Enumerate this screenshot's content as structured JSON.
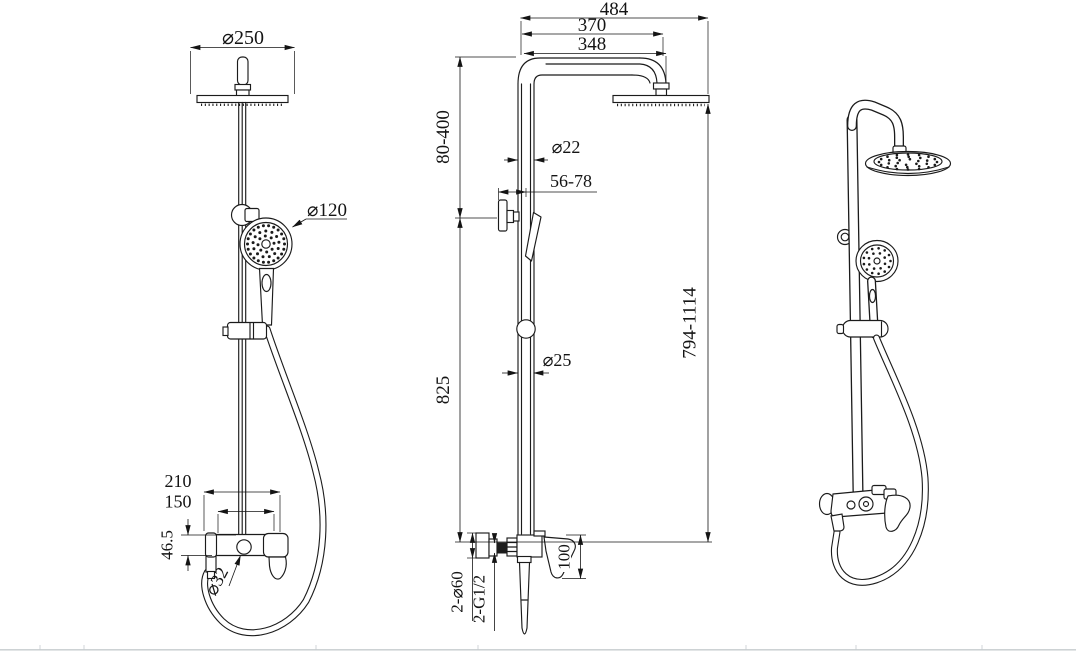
{
  "front_view": {
    "head_diameter": "⌀250",
    "hand_shower_diameter": "⌀120",
    "valve_width": "210",
    "inlet_spacing": "150",
    "valve_body_height": "46.5",
    "diverter_diameter": "⌀32"
  },
  "side_view": {
    "overall_depth": "484",
    "arm_reach": "370",
    "arm_length": "348",
    "top_adjust_range": "80-400",
    "upper_pipe_diameter": "⌀22",
    "wall_clearance": "56-78",
    "column_height": "825",
    "lower_pipe_diameter": "⌀25",
    "overall_height_range": "794-1114",
    "valve_drop": "100",
    "escutcheon_spec": "2-⌀60",
    "connection_thread": "2-G1/2"
  }
}
